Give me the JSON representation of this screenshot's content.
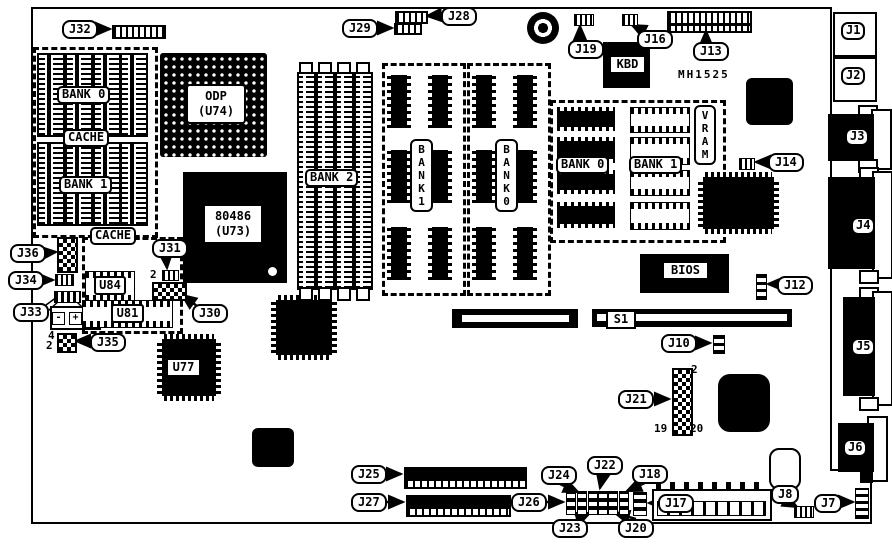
{
  "board": {
    "part_number": "MH1525"
  },
  "callouts": {
    "j7": "J7",
    "j8": "J8",
    "j10": "J10",
    "j12": "J12",
    "j13": "J13",
    "j14": "J14",
    "j16": "J16",
    "j17": "J17",
    "j18": "J18",
    "j19": "J19",
    "j20": "J20",
    "j21": "J21",
    "j22": "J22",
    "j23": "J23",
    "j24": "J24",
    "j25": "J25",
    "j26": "J26",
    "j27": "J27",
    "j28": "J28",
    "j29": "J29",
    "j30": "J30",
    "j31": "J31",
    "j32": "J32",
    "j33": "J33",
    "j34": "J34",
    "j35": "J35",
    "j36": "J36"
  },
  "ports": {
    "j1": "J1",
    "j2": "J2",
    "j3": "J3",
    "j4": "J4",
    "j5": "J5",
    "j6": "J6"
  },
  "chips": {
    "odp": "ODP\n(U74)",
    "cpu": "80486\n(U73)",
    "kbd": "KBD",
    "bios": "BIOS",
    "u84": "U84",
    "u81": "U81",
    "u77": "U77"
  },
  "memory": {
    "cache_bank0": "BANK 0",
    "cache_mid": "CACHE",
    "cache_bank1": "BANK 1",
    "cache2": "CACHE",
    "simm_bank": "BANK 2",
    "dram_bank1": "B\nA\nN\nK\n1",
    "dram_bank0": "B\nA\nN\nK\n0",
    "vram_bank0": "BANK 0",
    "vram_bank1": "BANK 1",
    "vram": "V\nR\nA\nM"
  },
  "slots": {
    "s1": "S1"
  },
  "pin_numbers": {
    "j31_pin2": "2",
    "j35_pin4": "4",
    "j35_pin2": "2",
    "j21_pin2": "2",
    "j21_pin19": "19",
    "j21_pin20": "20"
  },
  "battery": {
    "minus_left": "-",
    "plus": "+",
    "minus_right": "-"
  }
}
